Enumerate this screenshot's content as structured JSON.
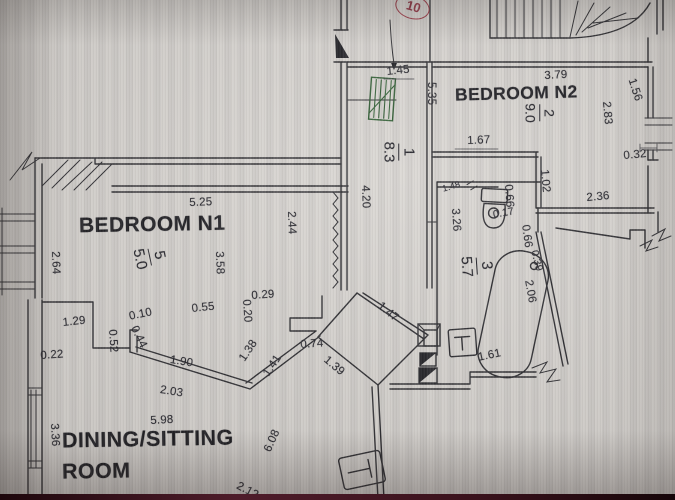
{
  "labels": {
    "bedroom_n1": "BEDROOM N1",
    "bedroom_n2": "BEDROOM N2",
    "dining_line1": "DINING/SITTING",
    "dining_line2": "ROOM"
  },
  "marker": {
    "value": "10",
    "color": "#9e3543"
  },
  "room_tags": [
    {
      "number": "1",
      "area": "8.3",
      "x": 399,
      "y": 152,
      "r": 90,
      "fs": 15
    },
    {
      "number": "2",
      "area": "9.0",
      "x": 540,
      "y": 113,
      "r": 90,
      "fs": 14
    },
    {
      "number": "3",
      "area": "5.7",
      "x": 477,
      "y": 266,
      "r": 86,
      "fs": 15
    },
    {
      "number": "5",
      "area": "5.0",
      "x": 150,
      "y": 257,
      "r": 78,
      "fs": 15
    }
  ],
  "dimensions": [
    {
      "value": "1.45",
      "x": 386,
      "y": 66,
      "r": -6
    },
    {
      "value": "5.35",
      "x": 437,
      "y": 82,
      "r": 90
    },
    {
      "value": "3.79",
      "x": 544,
      "y": 70,
      "r": -3
    },
    {
      "value": "1.56",
      "x": 637,
      "y": 77,
      "r": 72
    },
    {
      "value": "2.83",
      "x": 612,
      "y": 101,
      "r": 85
    },
    {
      "value": "1.67",
      "x": 467,
      "y": 135,
      "r": -2
    },
    {
      "value": "0.32",
      "x": 623,
      "y": 150,
      "r": -5
    },
    {
      "value": "1.02",
      "x": 550,
      "y": 169,
      "r": 85
    },
    {
      "value": "2.36",
      "x": 586,
      "y": 192,
      "r": -5
    },
    {
      "value": "4.20",
      "x": 371,
      "y": 185,
      "r": 88
    },
    {
      "value": "1.48",
      "x": 441,
      "y": 184,
      "r": -16,
      "fs": 9
    },
    {
      "value": "3.26",
      "x": 461,
      "y": 208,
      "r": 86
    },
    {
      "value": "0.66",
      "x": 514,
      "y": 184,
      "r": 86
    },
    {
      "value": "0.17",
      "x": 492,
      "y": 209,
      "r": -10,
      "fs": 10.5
    },
    {
      "value": "0.66",
      "x": 531,
      "y": 224,
      "r": 82
    },
    {
      "value": "0.39",
      "x": 540,
      "y": 249,
      "r": 76,
      "fs": 10.5
    },
    {
      "value": "2.06",
      "x": 534,
      "y": 279,
      "r": 80
    },
    {
      "value": "1.61",
      "x": 477,
      "y": 352,
      "r": -12
    },
    {
      "value": "5.25",
      "x": 189,
      "y": 197,
      "r": -2
    },
    {
      "value": "3.58",
      "x": 225,
      "y": 251,
      "r": 88
    },
    {
      "value": "2.44",
      "x": 297,
      "y": 211,
      "r": 88
    },
    {
      "value": "2.64",
      "x": 61,
      "y": 251,
      "r": 88
    },
    {
      "value": "0.29",
      "x": 251,
      "y": 290,
      "r": -4
    },
    {
      "value": "0.20",
      "x": 252,
      "y": 299,
      "r": 86
    },
    {
      "value": "0.55",
      "x": 191,
      "y": 303,
      "r": -6
    },
    {
      "value": "1.47",
      "x": 383,
      "y": 300,
      "r": 40
    },
    {
      "value": "0.10",
      "x": 128,
      "y": 311,
      "r": -12
    },
    {
      "value": "1.29",
      "x": 62,
      "y": 317,
      "r": -6
    },
    {
      "value": "0.44",
      "x": 139,
      "y": 324,
      "r": 64
    },
    {
      "value": "0.52",
      "x": 118,
      "y": 329,
      "r": 86
    },
    {
      "value": "0.22",
      "x": 40,
      "y": 350,
      "r": -4
    },
    {
      "value": "1.90",
      "x": 171,
      "y": 354,
      "r": 9
    },
    {
      "value": "2.03",
      "x": 161,
      "y": 384,
      "r": 9
    },
    {
      "value": "1.38",
      "x": 237,
      "y": 357,
      "r": -56
    },
    {
      "value": "1.41",
      "x": 261,
      "y": 372,
      "r": -56
    },
    {
      "value": "0.74",
      "x": 300,
      "y": 339,
      "r": -4
    },
    {
      "value": "1.39",
      "x": 329,
      "y": 354,
      "r": 40
    },
    {
      "value": "5.98",
      "x": 150,
      "y": 415,
      "r": -3
    },
    {
      "value": "3.36",
      "x": 60,
      "y": 423,
      "r": 87
    },
    {
      "value": "6.08",
      "x": 262,
      "y": 449,
      "r": -66
    },
    {
      "value": "2.12",
      "x": 240,
      "y": 480,
      "r": 28
    }
  ],
  "colors": {
    "paper": "#d8d5d1",
    "line": "#26262b",
    "marker_red": "#9e3543",
    "highlight_green": "#2d5c31"
  }
}
